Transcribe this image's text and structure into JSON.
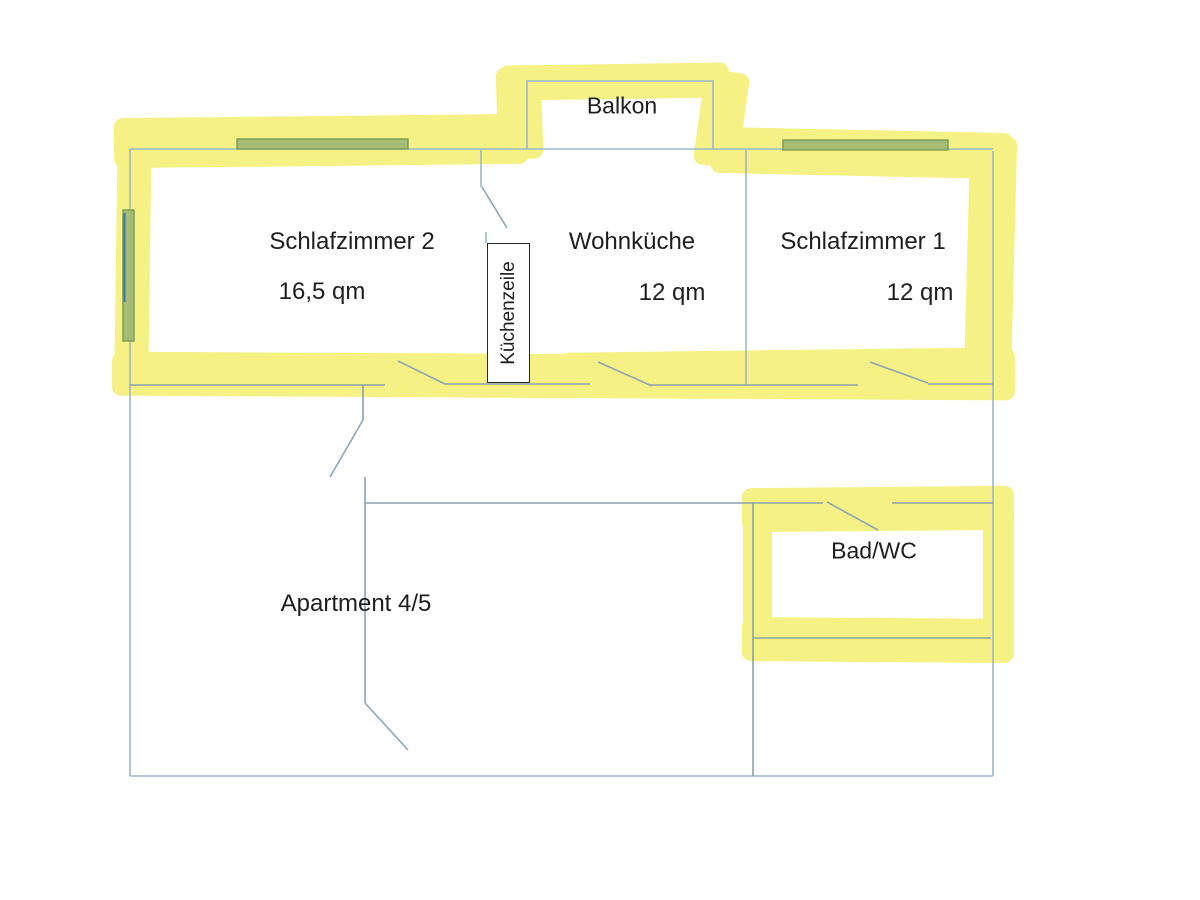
{
  "title": "Apartment 4/5 Grundriss",
  "rooms": {
    "balcony": {
      "label": "Balkon"
    },
    "bedroom2": {
      "label": "Schlafzimmer 2",
      "area": "16,5 qm"
    },
    "living_kitchen": {
      "label": "Wohnküche",
      "area": "12 qm"
    },
    "bedroom1": {
      "label": "Schlafzimmer 1",
      "area": "12 qm"
    },
    "kitchen_unit": {
      "label": "Küchenzeile"
    },
    "bathroom": {
      "label": "Bad/WC"
    },
    "apartment": {
      "label": "Apartment 4/5"
    }
  },
  "colors": {
    "highlight_yellow": "#f5f184",
    "window_green": "#a4bc74",
    "window_green_border": "#7b9a52",
    "window_accent_blue": "#3f74a6",
    "wall_line": "#9cb7c9",
    "wall_line_dark": "#8ba2ad",
    "door_line": "#8da6b4",
    "kitchen_box_border": "#262626",
    "text": "#1e1e1e"
  }
}
